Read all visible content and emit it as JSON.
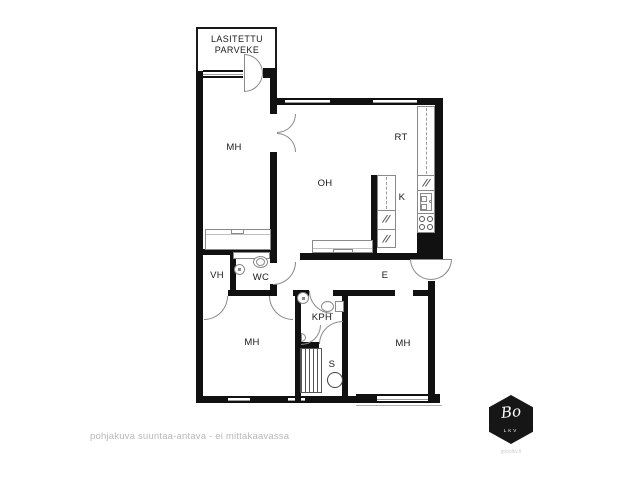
{
  "floorplan": {
    "balcony": {
      "line1": "LASITETTU",
      "line2": "PARVEKE"
    },
    "rooms": {
      "bedroom_top": "MH",
      "living_room": "OH",
      "dining": "RT",
      "kitchen": "K",
      "closet": "VH",
      "toilet": "WC",
      "entry": "E",
      "bathroom": "KPH",
      "sauna": "S",
      "bedroom_left": "MH",
      "bedroom_right": "MH"
    },
    "disclaimer": "pohjakuva suuntaa-antava - ei mittakaavassa",
    "colors": {
      "wall": "#111111",
      "fixture_line": "#8a8a8a",
      "label_text": "#1a1a1a",
      "disclaimer_text": "#b8b8b8",
      "logo_bg": "#161616"
    }
  },
  "logo": {
    "brand_script": "Bo",
    "brand_sub": "LKV",
    "website": "gobolkv.fi"
  }
}
